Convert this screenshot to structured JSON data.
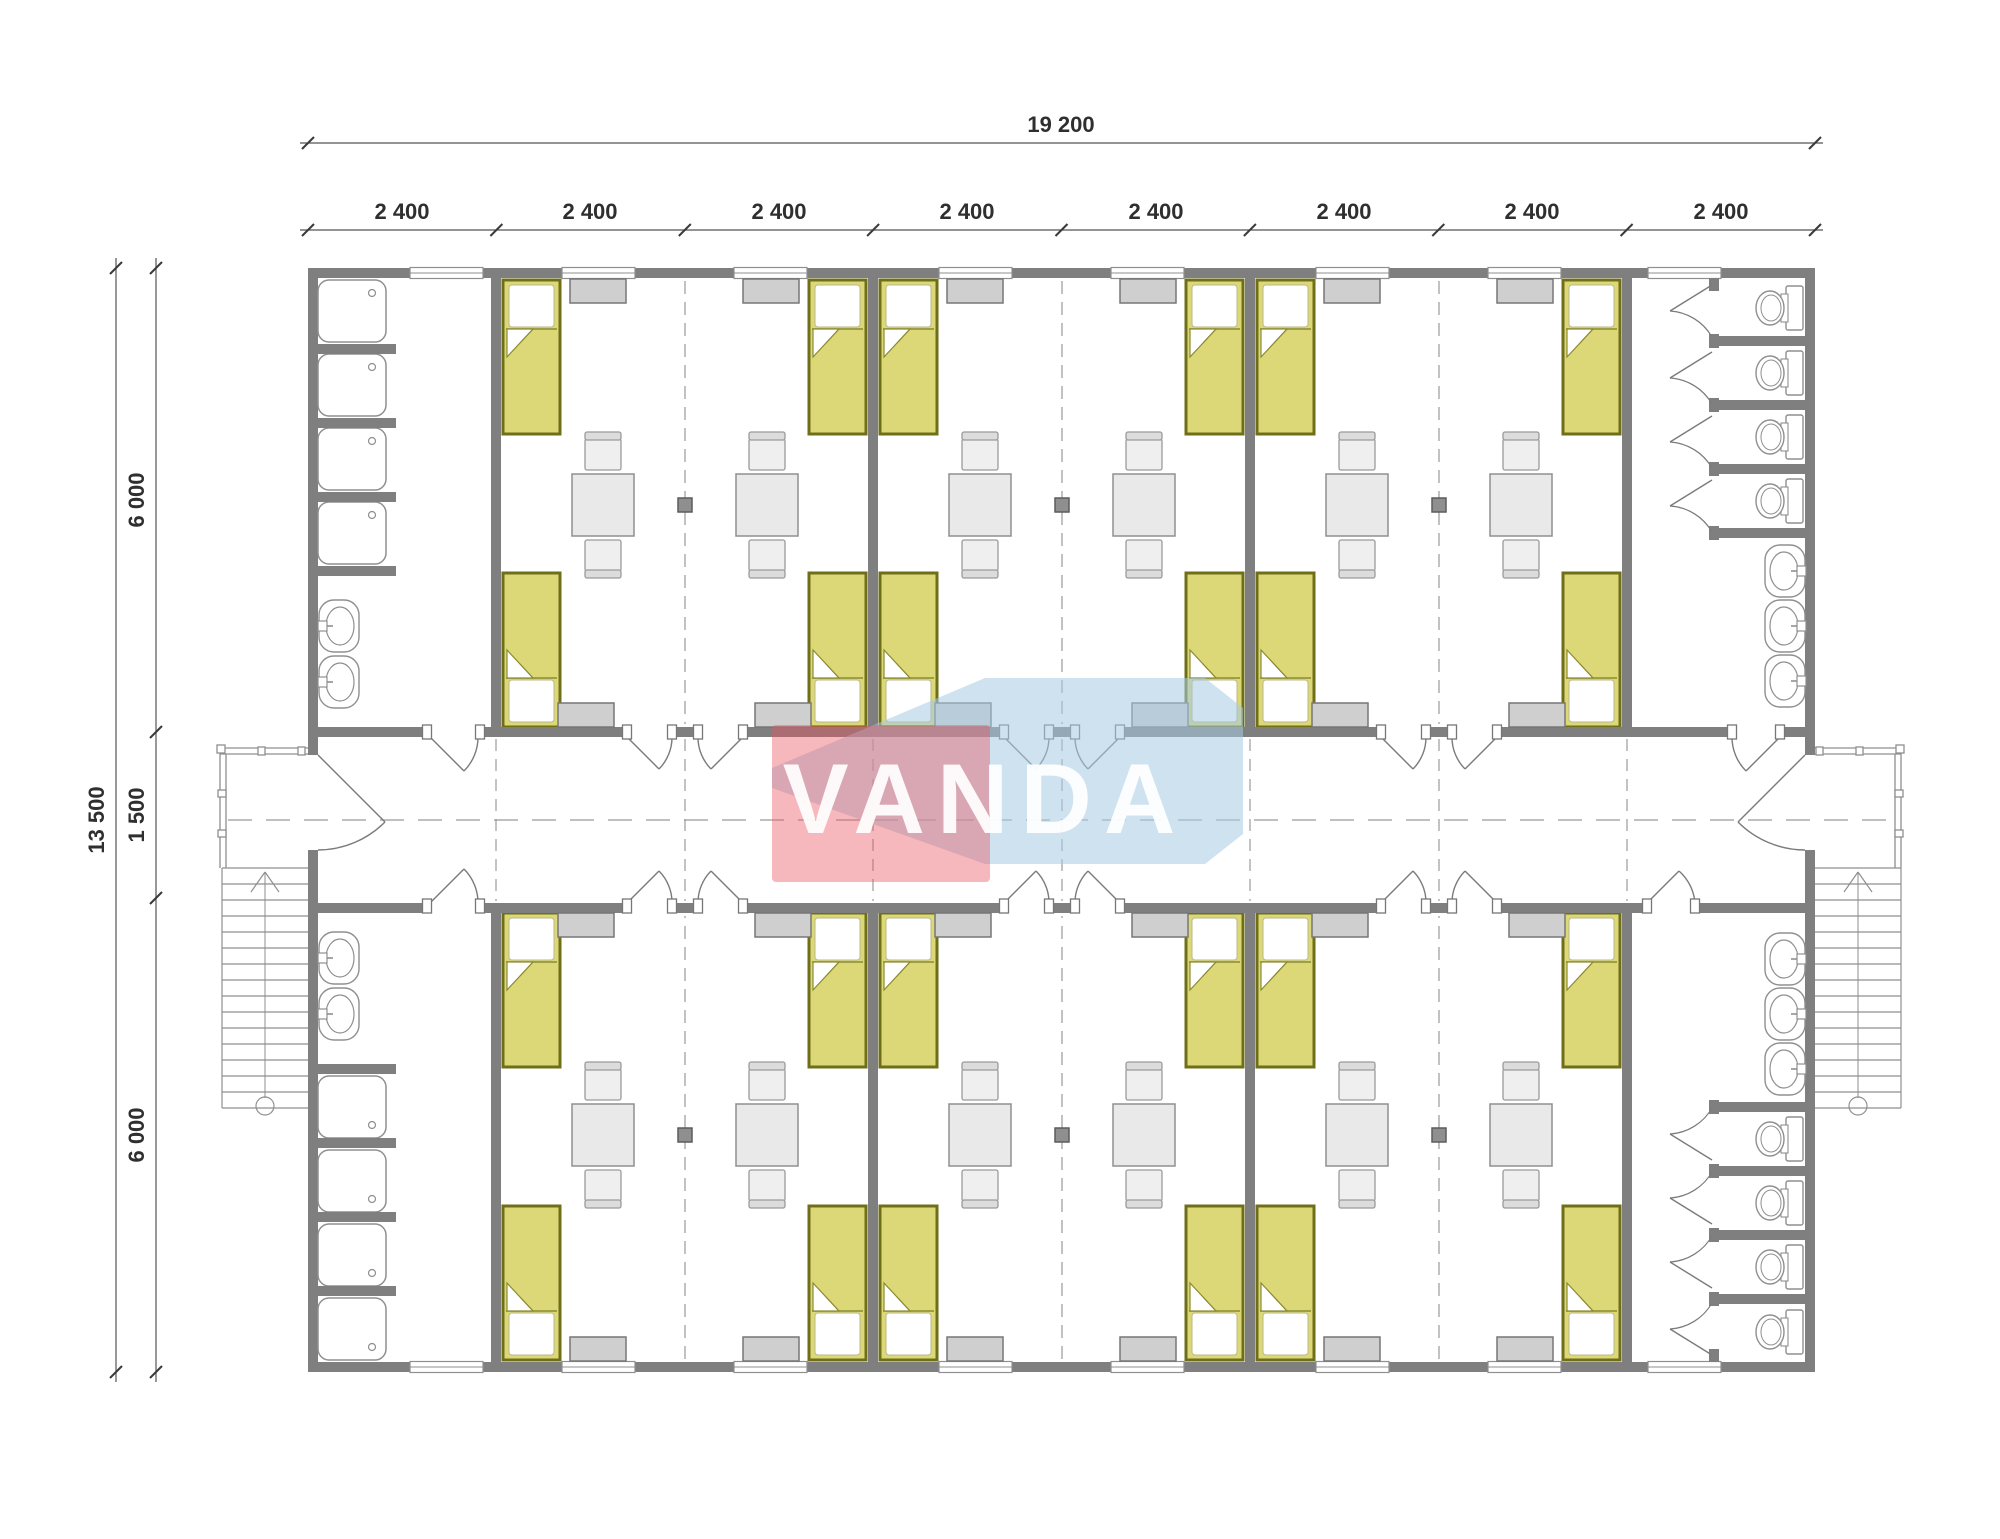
{
  "page": {
    "type": "architectural-floor-plan",
    "background": "#ffffff",
    "description": "Modular dormitory container building floor plan with central corridor, 3 shared rooms (4 beds each), shower room, WC room, two external staircases"
  },
  "watermark": {
    "text": "VANDA",
    "pink_color": "#ea5560",
    "blue_color": "#a5cbe4",
    "text_color": "#ffffff"
  },
  "dimensions": {
    "total_width": "19 200",
    "module_widths": [
      "2 400",
      "2 400",
      "2 400",
      "2 400",
      "2 400",
      "2 400",
      "2 400",
      "2 400"
    ],
    "total_height": "13 500",
    "height_segments": [
      "6 000",
      "1 500",
      "6 000"
    ]
  },
  "plan_contents": {
    "rooms": [
      "shower-room",
      "bedroom-1",
      "bedroom-2",
      "bedroom-3",
      "toilet-room"
    ],
    "beds_per_bedroom": 4,
    "tables_per_bedroom": 2,
    "showers": 8,
    "toilets": 8,
    "wash_basins": 10,
    "staircases": 2
  },
  "colors": {
    "wall": "#7f7f7f",
    "bed_fill": "#dcd878",
    "bed_border": "#6f6f1a",
    "furniture_fill": "#e8e8e8",
    "wardrobe_fill": "#cfcfcf",
    "fixture_line": "#8f8f8f",
    "dash_line": "#9b9b9b",
    "dimension": "#333333"
  }
}
